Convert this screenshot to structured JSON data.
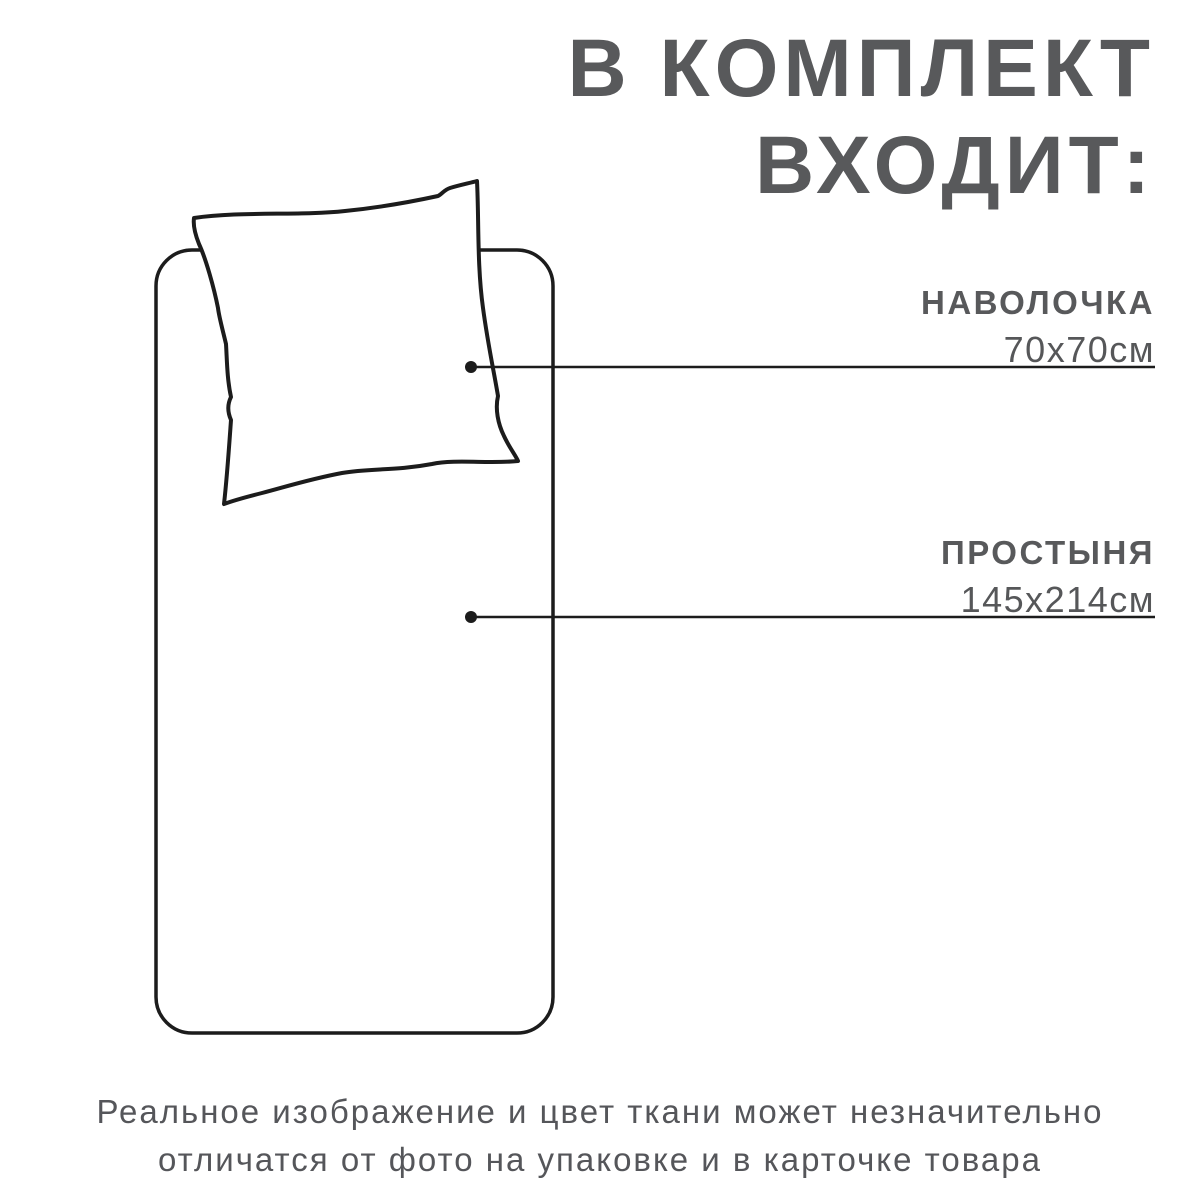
{
  "heading": {
    "line1": "В КОМПЛЕКТ",
    "line2": "ВХОДИТ:"
  },
  "items": [
    {
      "name": "НАВОЛОЧКА",
      "size": "70х70см"
    },
    {
      "name": "ПРОСТЫНЯ",
      "size": "145х214см"
    }
  ],
  "illustration": {
    "pillow": "pillow-outline-drawing",
    "sheet": "sheet-outline-drawing"
  },
  "footer": {
    "line1": "Реальное изображение и цвет ткани может незначительно",
    "line2": "отличатся от фото на упаковке и в карточке товара"
  },
  "colors": {
    "background": "#ffffff",
    "heading_text": "#58595b",
    "label_text": "#58595b",
    "footer_text": "#55565a",
    "outline_stroke": "#1c1c1c"
  }
}
